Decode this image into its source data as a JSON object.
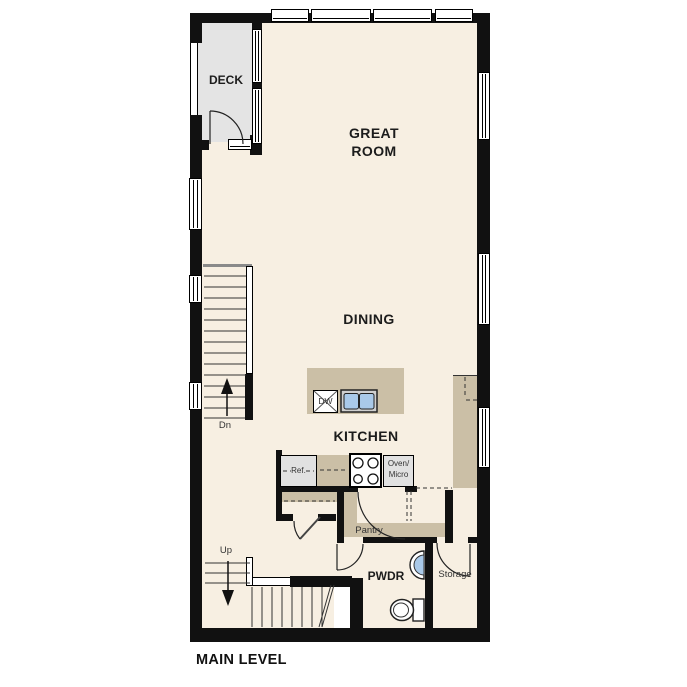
{
  "title": "MAIN LEVEL",
  "rooms": {
    "deck": {
      "label": "DECK"
    },
    "great_room": {
      "label": "GREAT ROOM"
    },
    "dining": {
      "label": "DINING"
    },
    "kitchen": {
      "label": "KITCHEN"
    },
    "pwdr": {
      "label": "PWDR"
    },
    "storage": {
      "label": "Storage"
    },
    "pantry": {
      "label": "Pantry"
    }
  },
  "fixtures": {
    "dishwasher": "DW",
    "refrigerator": "Ref.",
    "oven_line1": "Oven/",
    "oven_line2": "Micro"
  },
  "stairs": {
    "up": "Up",
    "down": "Dn"
  },
  "colors": {
    "wall": "#111111",
    "floor": "#f7efe2",
    "deck_floor": "#e4e4e4",
    "counter_tan": "#cbbfa6",
    "appliance_gray": "#e1e1e1",
    "sink_blue": "#a9c9e9",
    "line": "#222222"
  }
}
